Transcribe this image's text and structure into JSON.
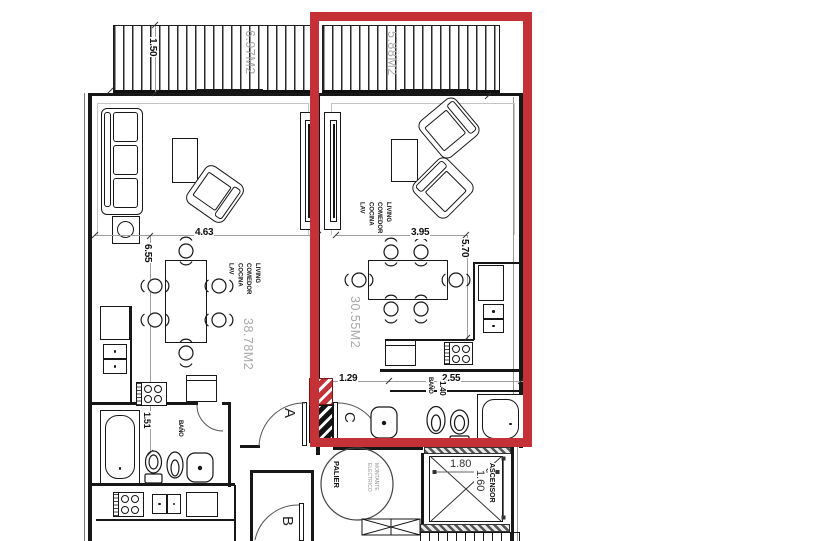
{
  "drawing": {
    "type": "floor-plan-crop",
    "highlight_color": "#c43238"
  },
  "left": {
    "living": "LIVING",
    "comedor": "COMEDOR",
    "cocina": "COCINA",
    "lav": "LAV",
    "area": "38.78M2",
    "width_dim": "4.63",
    "height_dim": "6.55",
    "bath_label": "BAÑO",
    "bath_dim": "1.51",
    "balcony_area": "6.97M2",
    "balcony_depth": "1.50"
  },
  "right": {
    "living": "LIVING",
    "comedor": "COMEDOR",
    "cocina": "COCINA",
    "lav": "LAV",
    "area": "30.55M2",
    "width_dim": "3.95",
    "height_dim": "5.70",
    "entry_dim": "1.29",
    "kitchen_dim": "2.55",
    "bath_label": "BAÑO",
    "bath_dim": "1.40",
    "balcony_area": "5.88M2"
  },
  "core": {
    "palier": "PALIER",
    "door_a": "A",
    "door_b": "B",
    "door_c": "C",
    "elevator": "ASCENSOR",
    "elevator_width": "1.80",
    "elevator_depth": "1.60",
    "riser_line1": "MONTANTE",
    "riser_line2": "ELECTRICO"
  }
}
